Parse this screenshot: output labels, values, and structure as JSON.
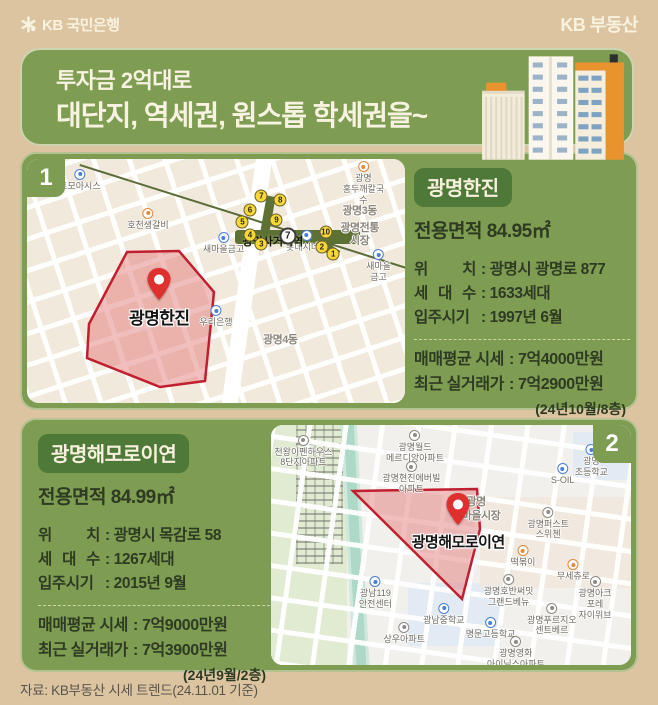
{
  "colors": {
    "tan": "#dcc4a1",
    "green": "#7e9d53",
    "dark_green": "#4e7939",
    "cream_text": "#f8f2e1",
    "ink": "#2e3a22",
    "poly_red": "#c01f2f",
    "building_orange": "#e8932e",
    "exit_yellow": "#f7d73a"
  },
  "header": {
    "bank_logo": "KB 국민은행",
    "brand": "KB 부동산"
  },
  "banner": {
    "line1": "투자금 2억대로",
    "line2": "대단지, 역세권, 원스톱 학세권을~"
  },
  "footer": {
    "source": "자료: KB부동산 시세 트렌드(24.11.01 기준)"
  },
  "sections": [
    {
      "index": "1",
      "title": "광명한진",
      "area": "전용면적 84.95㎡",
      "rows": [
        {
          "label": "위 치",
          "value": ": 광명시 광명로 877"
        },
        {
          "label": "세 대 수",
          "value": ": 1633세대"
        },
        {
          "label": "입주시기",
          "value": ": 1997년 6월"
        }
      ],
      "prices": [
        {
          "label": "매매평균 시세",
          "value": ": 7억4000만원"
        },
        {
          "label": "최근 실거래가",
          "value": ": 7억2900만원"
        }
      ],
      "note": "(24년10월/8층)",
      "map": {
        "pin_label": "광명한진",
        "station": {
          "name": "광명사거리역",
          "line": "7"
        },
        "exits": [
          {
            "n": "7",
            "x": 62,
            "y": 15
          },
          {
            "n": "8",
            "x": 67,
            "y": 17
          },
          {
            "n": "6",
            "x": 59,
            "y": 21
          },
          {
            "n": "5",
            "x": 57,
            "y": 26
          },
          {
            "n": "9",
            "x": 66,
            "y": 25
          },
          {
            "n": "4",
            "x": 59,
            "y": 31
          },
          {
            "n": "3",
            "x": 62,
            "y": 35
          },
          {
            "n": "10",
            "x": 79,
            "y": 30
          },
          {
            "n": "2",
            "x": 78,
            "y": 36
          },
          {
            "n": "1",
            "x": 81,
            "y": 39
          }
        ],
        "labels": [
          {
            "text": "토모아시스",
            "x": 14,
            "y": 4,
            "icon": "blue"
          },
          {
            "text": "호천생갈비",
            "x": 32,
            "y": 20,
            "icon": "orange"
          },
          {
            "text": "광명\n홍두깨칼국수",
            "x": 89,
            "y": 1,
            "icon": "orange"
          },
          {
            "text": "광명3동",
            "x": 88,
            "y": 15,
            "cls": "area"
          },
          {
            "text": "광명전통시장",
            "x": 88,
            "y": 22,
            "cls": "area"
          },
          {
            "text": "새마을금고",
            "x": 52,
            "y": 30,
            "icon": "blue"
          },
          {
            "text": "롯데시네마",
            "x": 74,
            "y": 29,
            "icon": "blue"
          },
          {
            "text": "새마을금고",
            "x": 93,
            "y": 37,
            "icon": "blue"
          },
          {
            "text": "우리은행",
            "x": 50,
            "y": 60,
            "icon": "blue"
          },
          {
            "text": "광명4동",
            "x": 67,
            "y": 68,
            "cls": "area"
          }
        ]
      }
    },
    {
      "index": "2",
      "title": "광명해모로이연",
      "area": "전용면적 84.99㎡",
      "rows": [
        {
          "label": "위 치",
          "value": ": 광명시 목감로 58"
        },
        {
          "label": "세 대 수",
          "value": ": 1267세대"
        },
        {
          "label": "입주시기",
          "value": ": 2015년 9월"
        }
      ],
      "prices": [
        {
          "label": "매매평균 시세",
          "value": ": 7억9000만원"
        },
        {
          "label": "최근 실거래가",
          "value": ": 7억3900만원"
        }
      ],
      "note": "(24년9월/2층)",
      "map": {
        "pin_label": "광명해모로이연",
        "labels": [
          {
            "text": "천왕이펜하우스\n8단지아파트",
            "x": 9,
            "y": 4,
            "icon": "gray"
          },
          {
            "text": "광명월드\n메르디앙아파트",
            "x": 40,
            "y": 2,
            "icon": "gray"
          },
          {
            "text": "광명현진에버빌\n아파트",
            "x": 39,
            "y": 15,
            "icon": "gray"
          },
          {
            "text": "광명\n초등학교",
            "x": 89,
            "y": 8,
            "icon": "blue"
          },
          {
            "text": "S-OIL",
            "x": 81,
            "y": 16,
            "icon": "blue"
          },
          {
            "text": "광명\n새마을시장",
            "x": 57,
            "y": 26,
            "cls": "area"
          },
          {
            "text": "광명퍼스트\n스위첸",
            "x": 77,
            "y": 34,
            "icon": "gray"
          },
          {
            "text": "떡볶이",
            "x": 70,
            "y": 50,
            "icon": "orange"
          },
          {
            "text": "무세츄로",
            "x": 84,
            "y": 56,
            "icon": "orange"
          },
          {
            "text": "광명호반써밋\n그랜드베뉴",
            "x": 66,
            "y": 62,
            "icon": "gray"
          },
          {
            "text": "광명아크포레\n자이위브",
            "x": 90,
            "y": 63,
            "icon": "gray"
          },
          {
            "text": "광명푸르지오\n센트베르",
            "x": 78,
            "y": 74,
            "icon": "gray"
          },
          {
            "text": "광남119\n안전센터",
            "x": 29,
            "y": 63,
            "icon": "blue"
          },
          {
            "text": "광남중학교",
            "x": 48,
            "y": 74,
            "icon": "blue"
          },
          {
            "text": "상우아파트",
            "x": 37,
            "y": 82,
            "icon": "gray"
          },
          {
            "text": "명문고등학교",
            "x": 61,
            "y": 80,
            "icon": "blue"
          },
          {
            "text": "광명영화\n아이닉스아파트",
            "x": 68,
            "y": 88,
            "icon": "gray"
          }
        ]
      }
    }
  ]
}
